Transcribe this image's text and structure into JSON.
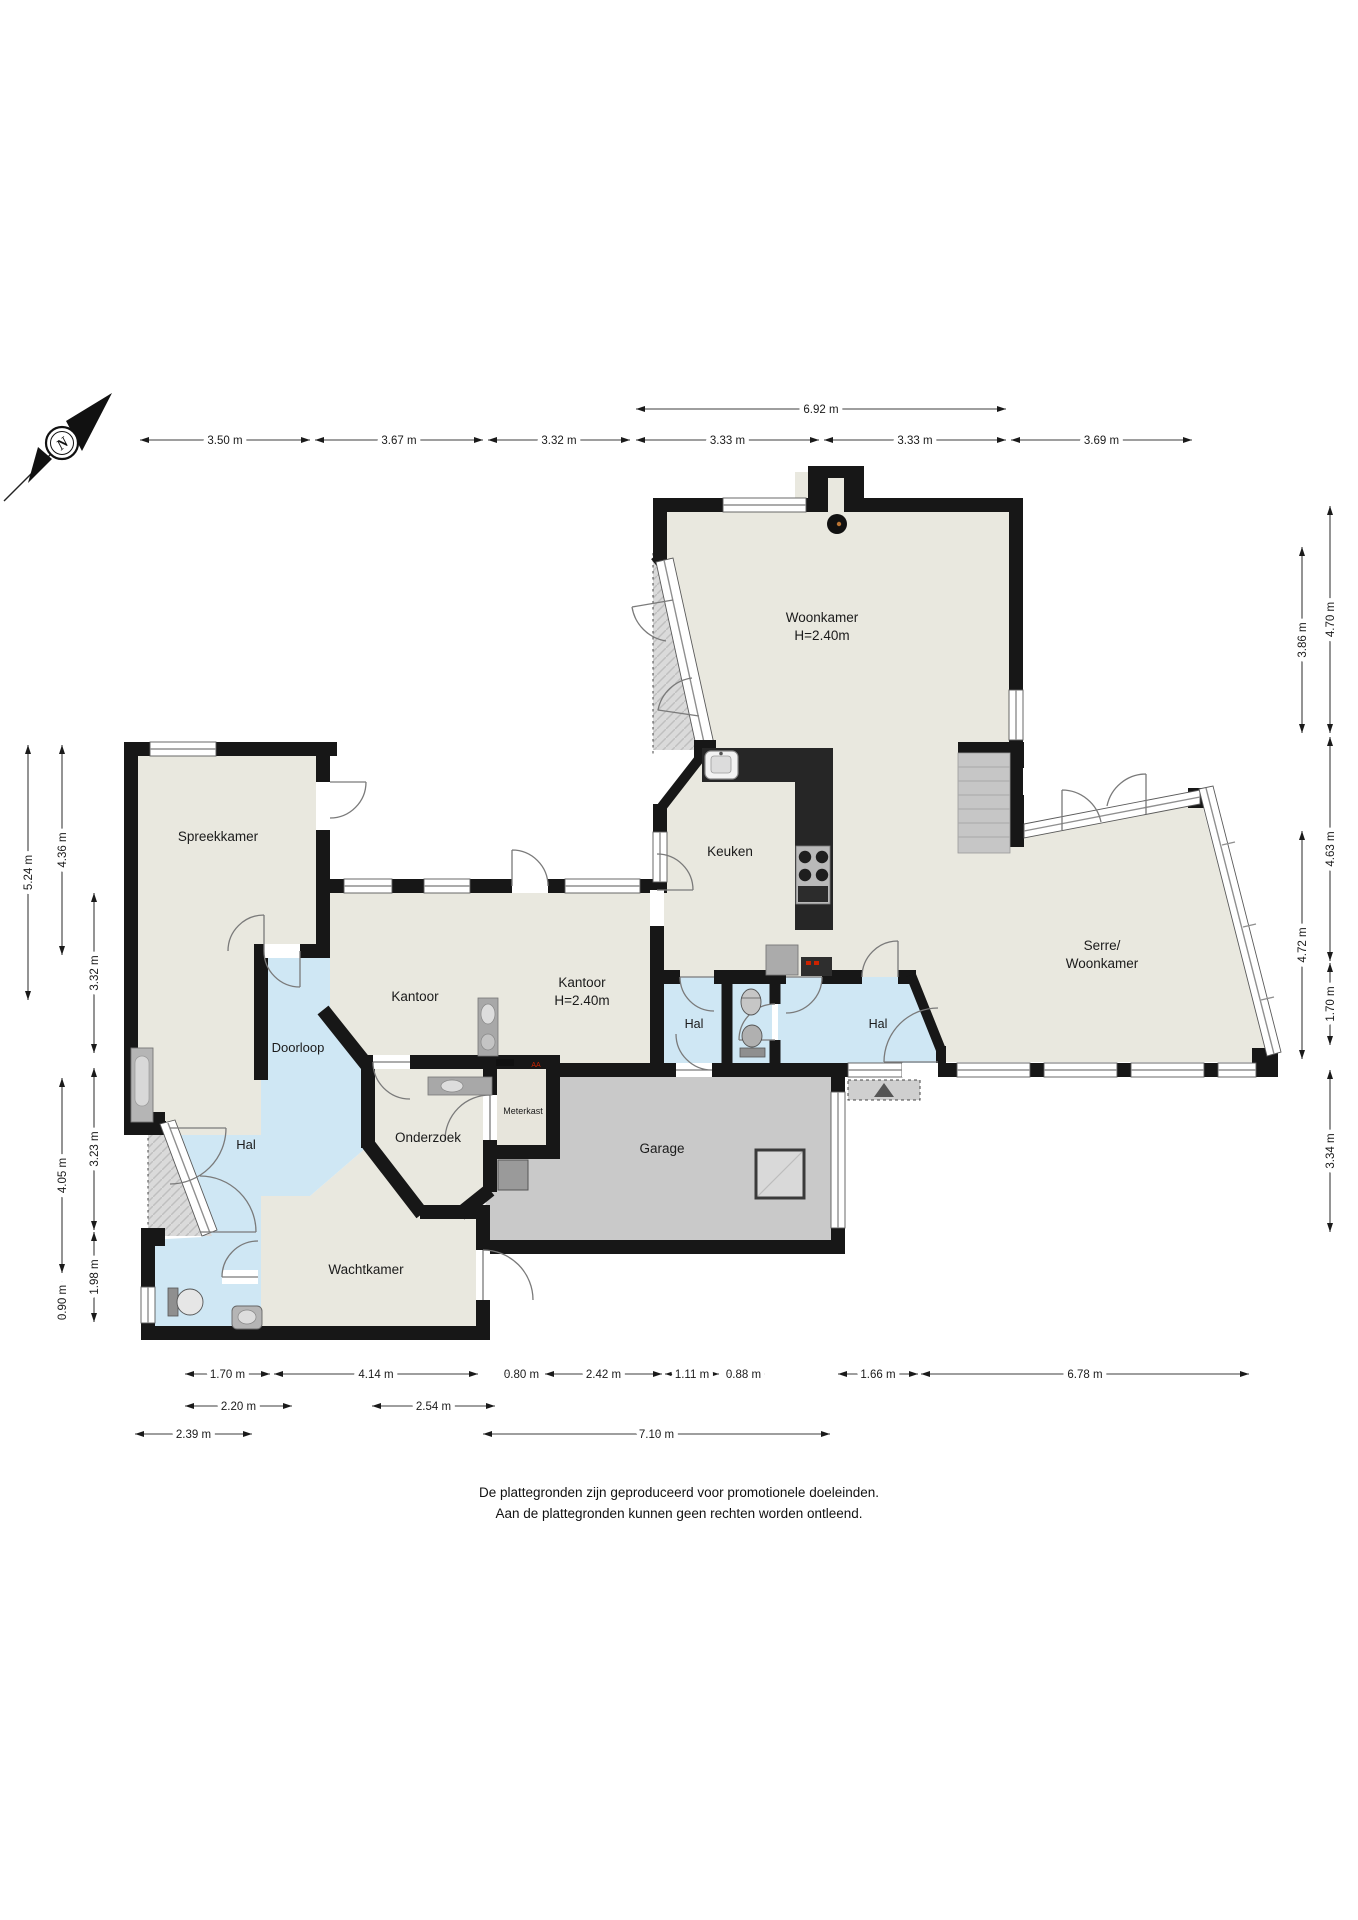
{
  "disclaimer": {
    "line1": "De plattegronden zijn geproduceerd voor promotionele doeleinden.",
    "line2": "Aan de plattegronden kunnen geen rechten worden ontleend."
  },
  "compass": {
    "label": "N"
  },
  "colors": {
    "wall": "#171717",
    "room_beige": "#e9e8df",
    "hall_blue": "#cfe7f4",
    "garage_gray": "#c9c9c9",
    "outside_gray": "#d9d9d9",
    "counter_dark": "#262626"
  },
  "rooms": [
    {
      "id": "woonkamer",
      "lines": [
        "Woonkamer",
        "H=2.40m"
      ],
      "x": 822,
      "y": 622,
      "size": 13.5
    },
    {
      "id": "keuken",
      "lines": [
        "Keuken"
      ],
      "x": 730,
      "y": 856,
      "size": 13.5
    },
    {
      "id": "serre",
      "lines": [
        "Serre/",
        "Woonkamer"
      ],
      "x": 1102,
      "y": 950,
      "size": 13.5
    },
    {
      "id": "spreekkamer",
      "lines": [
        "Spreekkamer"
      ],
      "x": 218,
      "y": 841,
      "size": 13.5
    },
    {
      "id": "kantoor-1",
      "lines": [
        "Kantoor"
      ],
      "x": 415,
      "y": 1001,
      "size": 13.5
    },
    {
      "id": "kantoor-2",
      "lines": [
        "Kantoor",
        "H=2.40m"
      ],
      "x": 582,
      "y": 987,
      "size": 13.5
    },
    {
      "id": "doorloop",
      "lines": [
        "Doorloop"
      ],
      "x": 298,
      "y": 1052,
      "size": 13
    },
    {
      "id": "hal-links",
      "lines": [
        "Hal"
      ],
      "x": 246,
      "y": 1149,
      "size": 13
    },
    {
      "id": "onderzoek",
      "lines": [
        "Onderzoek"
      ],
      "x": 428,
      "y": 1142,
      "size": 13.5
    },
    {
      "id": "meterkast",
      "lines": [
        "Meterkast"
      ],
      "x": 523,
      "y": 1114,
      "size": 9
    },
    {
      "id": "wachtkamer",
      "lines": [
        "Wachtkamer"
      ],
      "x": 366,
      "y": 1274,
      "size": 13.5
    },
    {
      "id": "garage",
      "lines": [
        "Garage"
      ],
      "x": 662,
      "y": 1153,
      "size": 13.5
    },
    {
      "id": "hal-midden",
      "lines": [
        "Hal"
      ],
      "x": 694,
      "y": 1028,
      "size": 12.5
    },
    {
      "id": "hal-rechts",
      "lines": [
        "Hal"
      ],
      "x": 878,
      "y": 1028,
      "size": 12.5
    }
  ],
  "dimensions": [
    {
      "label": "6.92 m",
      "o": "h",
      "x1": 636,
      "x2": 1006,
      "y": 409
    },
    {
      "label": "3.50 m",
      "o": "h",
      "x1": 140,
      "x2": 310,
      "y": 440
    },
    {
      "label": "3.67 m",
      "o": "h",
      "x1": 315,
      "x2": 483,
      "y": 440
    },
    {
      "label": "3.32 m",
      "o": "h",
      "x1": 488,
      "x2": 630,
      "y": 440
    },
    {
      "label": "3.33 m",
      "o": "h",
      "x1": 636,
      "x2": 819,
      "y": 440
    },
    {
      "label": "3.33 m",
      "o": "h",
      "x1": 824,
      "x2": 1006,
      "y": 440
    },
    {
      "label": "3.69 m",
      "o": "h",
      "x1": 1011,
      "x2": 1192,
      "y": 440
    },
    {
      "label": "5.24 m",
      "o": "v",
      "x": 28,
      "y1": 745,
      "y2": 1000
    },
    {
      "label": "4.36 m",
      "o": "v",
      "x": 62,
      "y1": 745,
      "y2": 955
    },
    {
      "label": "3.32 m",
      "o": "v",
      "x": 94,
      "y1": 893,
      "y2": 1053
    },
    {
      "label": "3.23 m",
      "o": "v",
      "x": 94,
      "y1": 1068,
      "y2": 1230
    },
    {
      "label": "4.05 m",
      "o": "v",
      "x": 62,
      "y1": 1078,
      "y2": 1273
    },
    {
      "label": "1.98 m",
      "o": "v",
      "x": 94,
      "y1": 1232,
      "y2": 1322
    },
    {
      "label": "0.90 m",
      "o": "v",
      "x": 62,
      "y1": 1281,
      "y2": 1324
    },
    {
      "label": "4.70 m",
      "o": "v",
      "x": 1330,
      "y1": 506,
      "y2": 733
    },
    {
      "label": "3.86 m",
      "o": "v",
      "x": 1302,
      "y1": 547,
      "y2": 733
    },
    {
      "label": "4.63 m",
      "o": "v",
      "x": 1330,
      "y1": 737,
      "y2": 961
    },
    {
      "label": "4.72 m",
      "o": "v",
      "x": 1302,
      "y1": 831,
      "y2": 1059
    },
    {
      "label": "1.70 m",
      "o": "v",
      "x": 1330,
      "y1": 963,
      "y2": 1045
    },
    {
      "label": "3.34 m",
      "o": "v",
      "x": 1330,
      "y1": 1070,
      "y2": 1232
    },
    {
      "label": "1.70 m",
      "o": "h",
      "x1": 185,
      "x2": 270,
      "y": 1374
    },
    {
      "label": "4.14 m",
      "o": "h",
      "x1": 274,
      "x2": 478,
      "y": 1374
    },
    {
      "label": "0.80 m",
      "o": "h",
      "x1": 502,
      "x2": 541,
      "y": 1374
    },
    {
      "label": "2.42 m",
      "o": "h",
      "x1": 545,
      "x2": 662,
      "y": 1374
    },
    {
      "label": "1.11 m",
      "o": "h",
      "x1": 665,
      "x2": 719,
      "y": 1374
    },
    {
      "label": "0.88 m",
      "o": "h",
      "x1": 722,
      "x2": 765,
      "y": 1374
    },
    {
      "label": "1.66 m",
      "o": "h",
      "x1": 838,
      "x2": 918,
      "y": 1374
    },
    {
      "label": "6.78 m",
      "o": "h",
      "x1": 921,
      "x2": 1249,
      "y": 1374
    },
    {
      "label": "2.20 m",
      "o": "h",
      "x1": 185,
      "x2": 292,
      "y": 1406
    },
    {
      "label": "2.54 m",
      "o": "h",
      "x1": 372,
      "x2": 495,
      "y": 1406
    },
    {
      "label": "2.39 m",
      "o": "h",
      "x1": 135,
      "x2": 252,
      "y": 1434
    },
    {
      "label": "7.10 m",
      "o": "h",
      "x1": 483,
      "x2": 830,
      "y": 1434
    }
  ]
}
